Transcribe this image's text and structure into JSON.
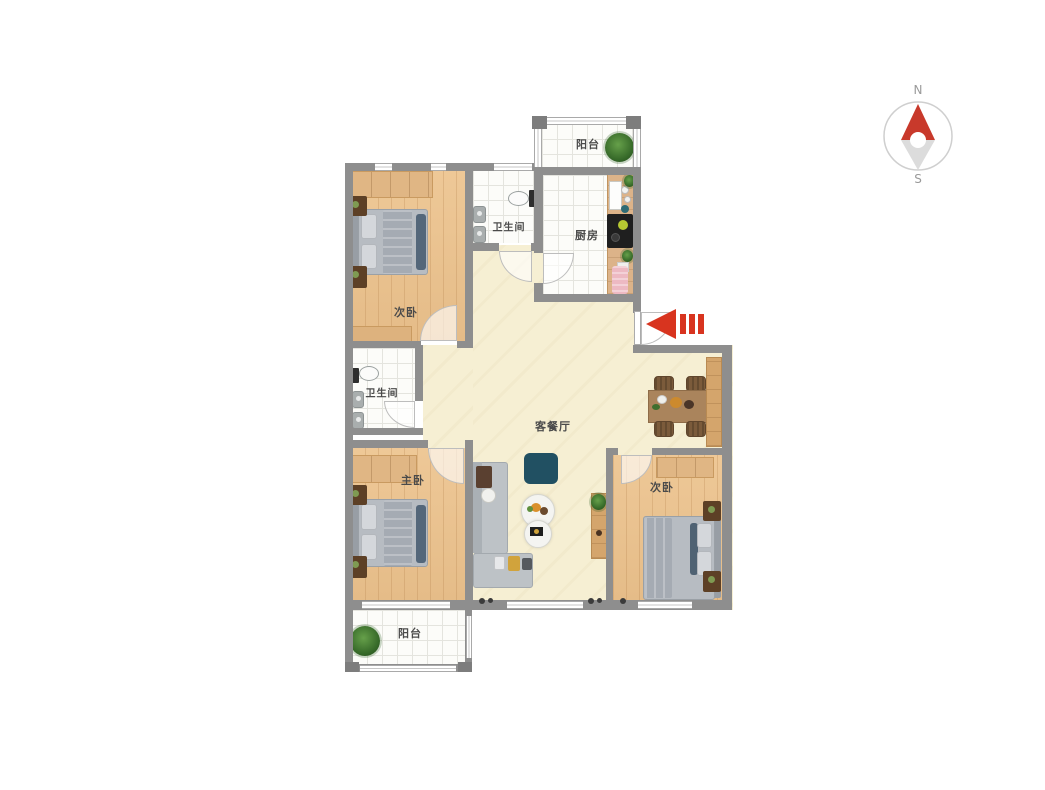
{
  "meta": {
    "type": "apartment-floor-plan"
  },
  "colors": {
    "wall": "#8e8e8e",
    "living": "#f6efd3",
    "wood_floor": "#eac393",
    "accent_red": "#d8341f",
    "dark_teal": "#215062",
    "bed_gray": "#b7bcc2",
    "dark_slate": "#54677a",
    "nightstand": "#5d4026",
    "plant_green": "#3a7a2e",
    "label_text": "#4a4a4a"
  },
  "rooms": {
    "balcony_top": {
      "label": "阳台"
    },
    "kitchen": {
      "label": "厨房"
    },
    "bathroom_top": {
      "label": "卫生间"
    },
    "bedroom_top_left": {
      "label": "次卧"
    },
    "bathroom_mid": {
      "label": "卫生间"
    },
    "living_dining": {
      "label": "客餐厅"
    },
    "bedroom_master": {
      "label": "主卧"
    },
    "bedroom_right": {
      "label": "次卧"
    },
    "balcony_bottom": {
      "label": "阳台"
    }
  },
  "compass": {
    "north": "N",
    "south": "S"
  }
}
